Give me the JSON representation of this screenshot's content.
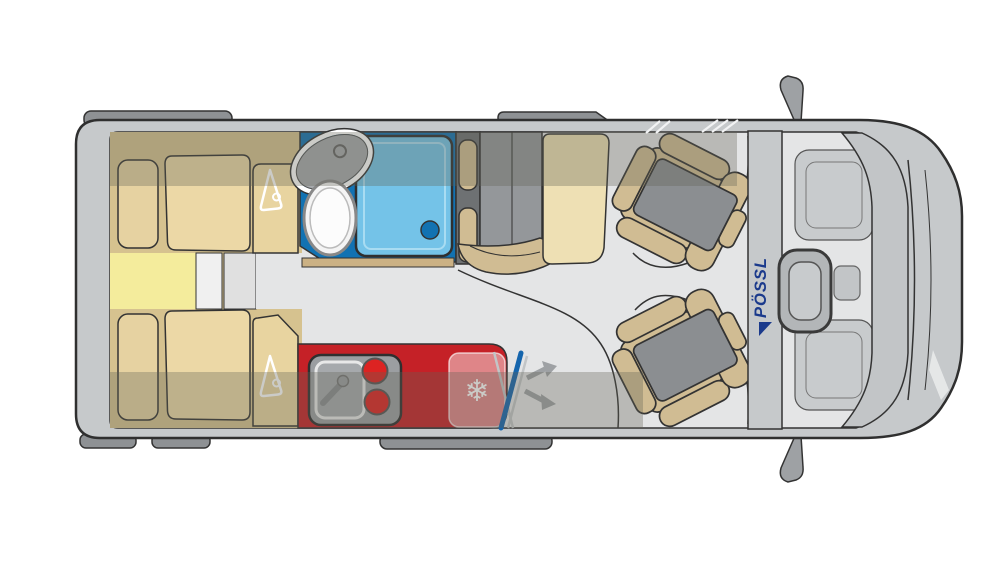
{
  "diagram": {
    "brand": {
      "logo_text": "PÖSSL"
    },
    "glyphs": {
      "snowflake": "❄"
    },
    "icons": {
      "wardrobe_top": "hanger-icon",
      "wardrobe_bottom": "hanger-icon",
      "fridge": "snowflake-icon",
      "table_swivel": "double-arrow-icon"
    }
  },
  "colors": {
    "body": "#c6c9cb",
    "floor": "#e4e5e6",
    "fitting": "#8e9194",
    "bed_base": "#d6c28f",
    "mattress": "#ecd8a6",
    "pillow": "#e6d2a1",
    "bed_yellow": "#f4ec9c",
    "panel_white": "#f0f0f0",
    "panel_gray": "#e0e0e0",
    "wardrobe": "#e8d4a0",
    "bath_blue": "#1272b2",
    "shower_blue": "#74c3e8",
    "threshold_tan": "#cbb184",
    "bench_dark": "#6e7173",
    "bench_gray": "#94979a",
    "unit_gray": "#9b9ea1",
    "basin_gray": "#a6a9ac",
    "kitchen_red": "#c52127",
    "burner_red": "#dd2322",
    "fridge_overlay": "rgba(255,255,255,0.45)",
    "seat_tan": "#d0bc93",
    "seat_gray": "#8b8e91",
    "table_cream": "#eee0b4",
    "pole_blue": "#1565ad",
    "arrow_gray": "#9ea1a4",
    "overlay": "rgba(98,96,86,0.33)",
    "logo_blue": "#1b3a8c",
    "white": "#ffffff",
    "pedestal": "#c8cbcd",
    "cab_detail": "#c2c5c7",
    "glass_line": "#c2c5c7"
  }
}
